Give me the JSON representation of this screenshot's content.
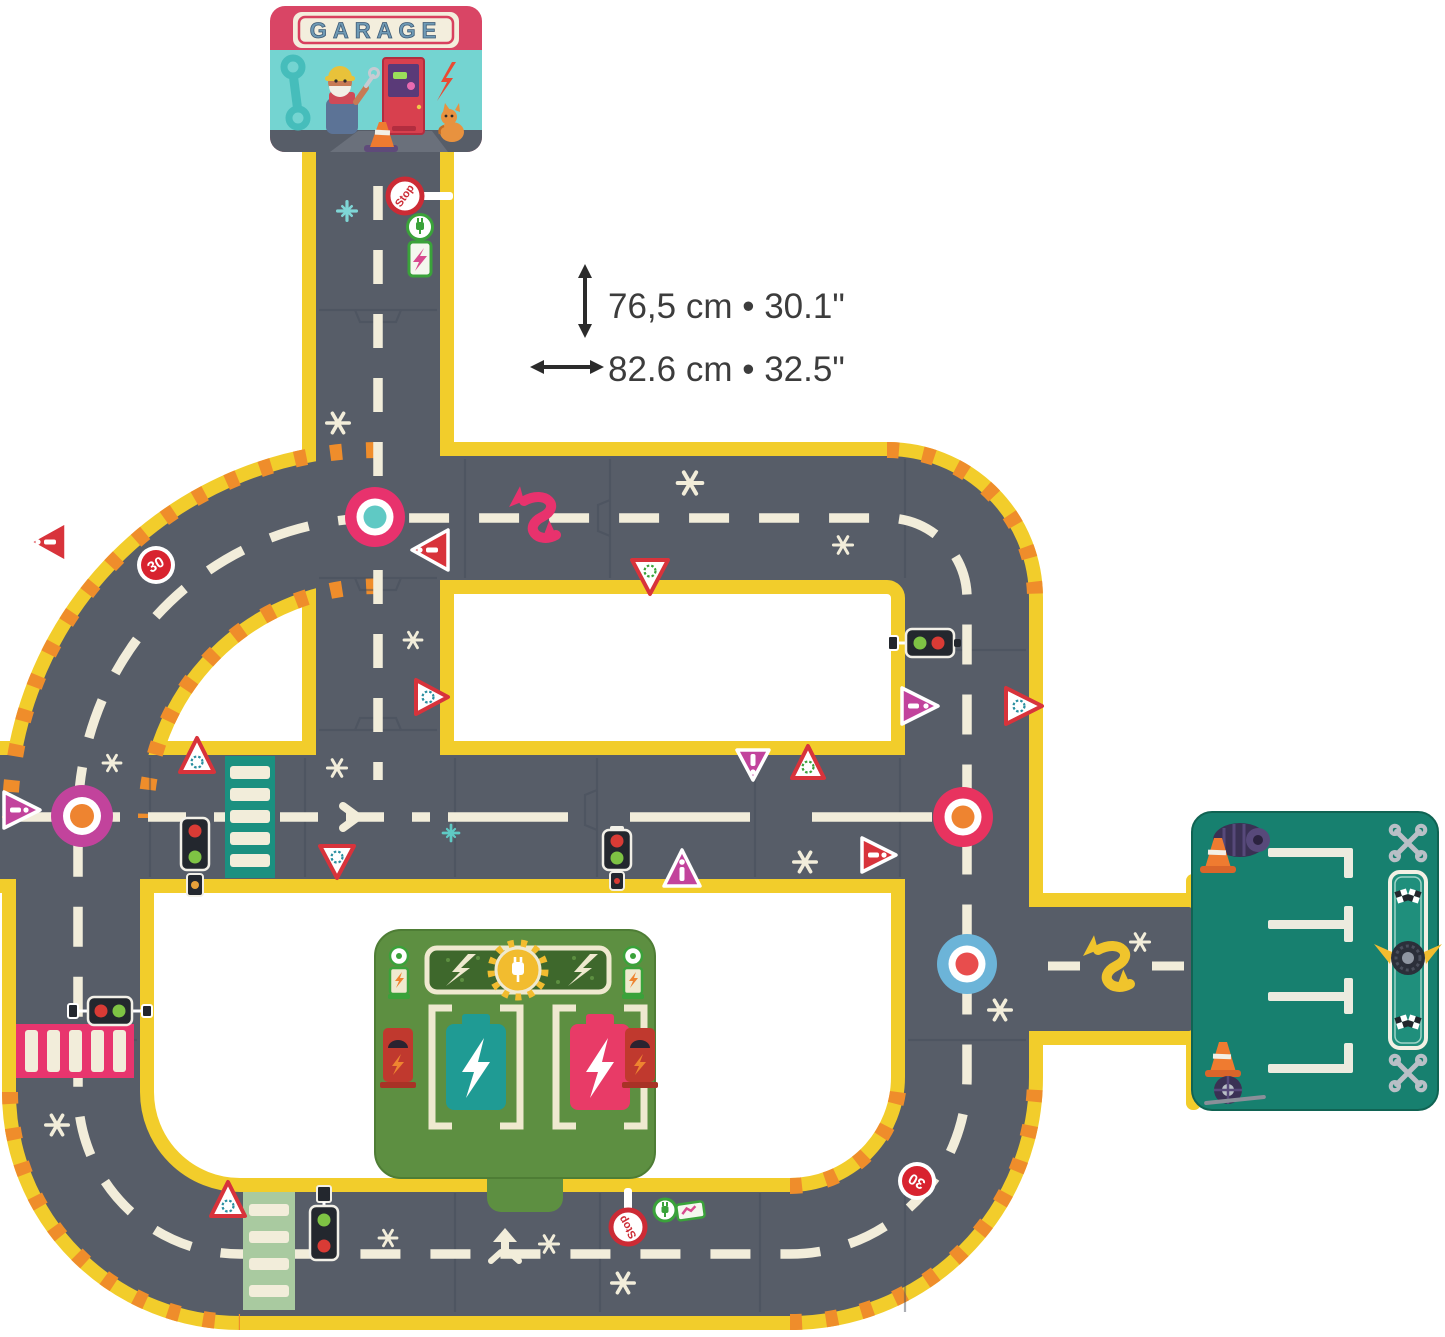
{
  "annotations": {
    "height_label": "76,5 cm • 30.1\"",
    "width_label": "82.6 cm • 32.5\""
  },
  "garage": {
    "sign_text": "GARAGE"
  },
  "signs": {
    "speed_limit": "30",
    "stop": "Stop"
  },
  "icons": [
    "stop-sign-icon",
    "speed-30-sign-icon",
    "ev-charge-sign-icon",
    "traffic-light-icon",
    "roundabout-sign-icon",
    "warning-triangle-icon",
    "crosswalk-icon",
    "merge-arrow-icon",
    "s-curve-arrow-icon",
    "wrench-icon",
    "lightning-icon",
    "tire-icon",
    "cone-icon",
    "checkered-flag-icon",
    "battery-icon",
    "plug-icon",
    "sparkle-icon"
  ],
  "colors": {
    "road": "#575d68",
    "road_edge_yellow": "#f2cd2b",
    "lane_marking": "#f2edda",
    "hazard_orange": "#ef8d2b",
    "garage_crimson": "#d94565",
    "garage_teal_wall": "#74d4d1",
    "magenta": "#c2439c",
    "sign_red": "#d8333b",
    "station_green": "#5d8f41",
    "parking_teal": "#17806f",
    "battery_teal": "#1f9b94",
    "battery_pink": "#e83b67",
    "crosswalk_teal": "#1b9080",
    "crosswalk_pink": "#e8356e",
    "crosswalk_light_green": "#a9caa0",
    "roundabout_pink": "#e8326d",
    "roundabout_blue": "#6cb4d8"
  }
}
